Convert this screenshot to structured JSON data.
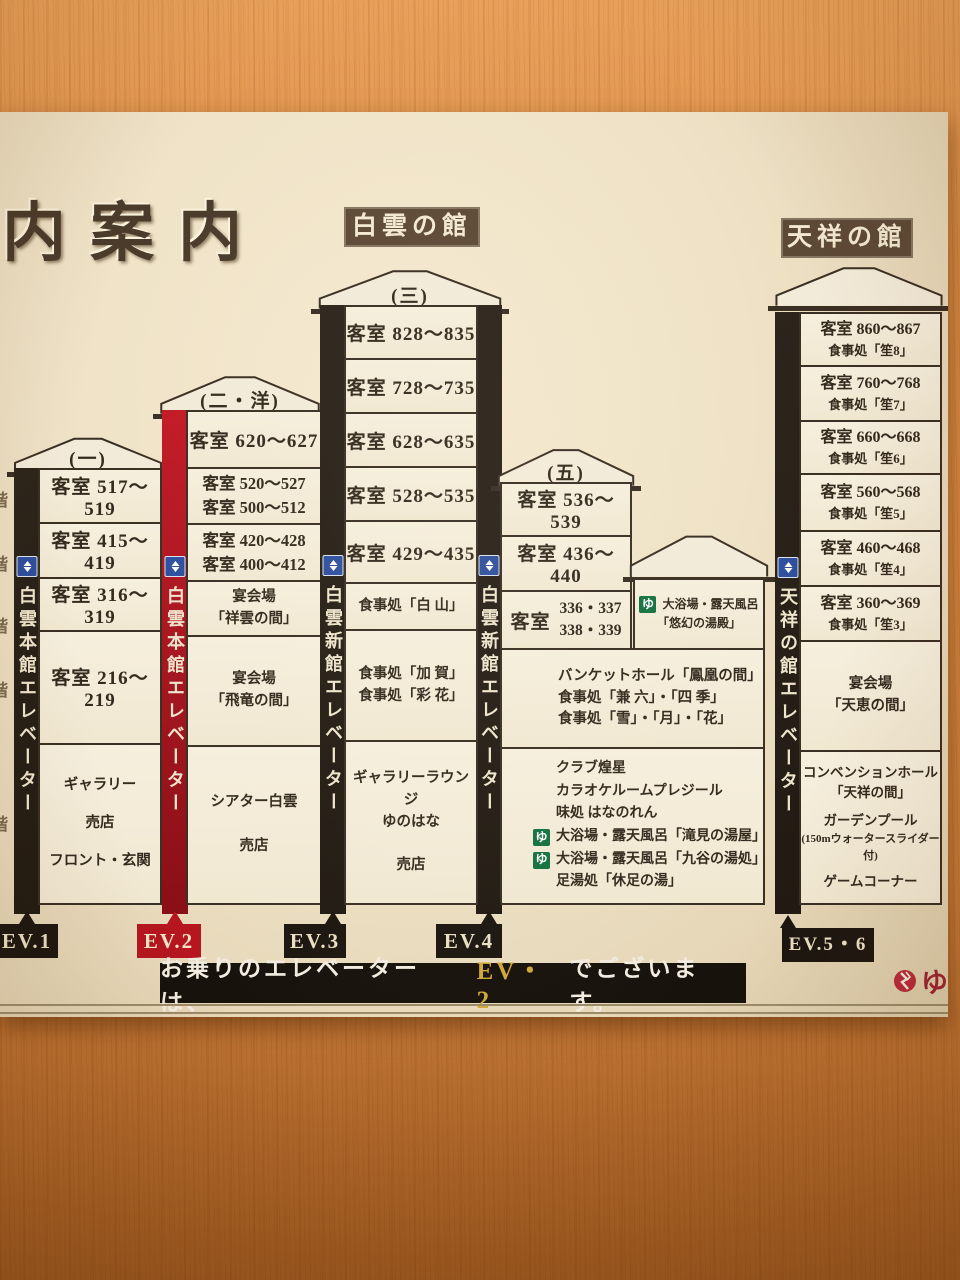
{
  "sign": {
    "title": "内案内",
    "badges": {
      "hakuun": "白雲の館",
      "tensho": "天祥の館"
    },
    "floor_marker": "階",
    "towers": {
      "t1": {
        "roof_label": "(一)",
        "elevator_label": "白雲本館エレベーター",
        "ev_badge": "EV.1",
        "floors": [
          [
            "客室 517〜519"
          ],
          [
            "客室 415〜419"
          ],
          [
            "客室 316〜319"
          ],
          [
            "客室 216〜219"
          ],
          [
            "ギャラリー",
            "売店",
            "フロント・玄関"
          ]
        ]
      },
      "t2": {
        "roof_label": "(二・洋)",
        "elevator_label": "白雲本館エレベーター",
        "ev_badge": "EV.2",
        "floors": [
          [
            "客室 620〜627"
          ],
          [
            "客室 520〜527",
            "客室 500〜512"
          ],
          [
            "客室 420〜428",
            "客室 400〜412"
          ],
          [
            "宴会場",
            "「祥雲の間」"
          ],
          [
            "宴会場",
            "「飛竜の間」"
          ],
          [
            "シアター白雲",
            "売店"
          ]
        ]
      },
      "t3": {
        "roof_label": "(三)",
        "elevator_label_left": "白雲新館エレベーター",
        "elevator_label_right": "白雲新館エレベーター",
        "ev_badge_left": "EV.3",
        "ev_badge_right": "EV.4",
        "floors": [
          [
            "客室 828〜835"
          ],
          [
            "客室 728〜735"
          ],
          [
            "客室 628〜635"
          ],
          [
            "客室 528〜535"
          ],
          [
            "客室 429〜435"
          ],
          [
            "食事処「白 山」"
          ],
          [
            "食事処「加 賀」",
            "食事処「彩 花」"
          ],
          [
            "ギャラリーラウンジ",
            "ゆのはな",
            "売店"
          ]
        ]
      },
      "t4": {
        "roof_label": "(五)",
        "floors": [
          [
            "客室 536〜539"
          ],
          [
            "客室 436〜440"
          ]
        ],
        "f3": {
          "label": "客室",
          "nums": [
            "336・337",
            "338・339"
          ]
        },
        "wide1": [
          "バンケットホール「鳳凰の間」",
          "食事処「兼 六」・「四 季」",
          "食事処「雪」・「月」・「花」"
        ],
        "wide2": [
          "クラブ煌星",
          "カラオケルームプレジール",
          "味処 はなのれん",
          "大浴場・露天風呂「滝見の湯屋」",
          "大浴場・露天風呂「九谷の湯処」",
          "足湯処「休足の湯」"
        ]
      },
      "annex_bath": {
        "lines": [
          "大浴場・露天風呂",
          "「悠幻の湯殿」"
        ]
      },
      "t5": {
        "elevator_label": "天祥の館エレベーター",
        "ev_badge": "EV.5・6",
        "floors": [
          [
            "客室 860〜867",
            "食事処「笙8」"
          ],
          [
            "客室 760〜768",
            "食事処「笙7」"
          ],
          [
            "客室 660〜668",
            "食事処「笙6」"
          ],
          [
            "客室 560〜568",
            "食事処「笙5」"
          ],
          [
            "客室 460〜468",
            "食事処「笙4」"
          ],
          [
            "客室 360〜369",
            "食事処「笙3」"
          ],
          [
            "宴会場",
            "「天恵の間」"
          ],
          [
            "コンベンションホール",
            "「天祥の間」",
            "ガーデンプール",
            "(150mウォータースライダー付)",
            "ゲームコーナー"
          ]
        ]
      }
    },
    "notice": {
      "pre": "お乗りのエレベーターは、",
      "ev": "EV・2",
      "post": "でございます。"
    },
    "icons": {
      "bath": "ゆ",
      "logo": "ゆ"
    },
    "colors": {
      "accent_red": "#b5161f",
      "bar_black": "#262019",
      "gold": "#d0a73c",
      "badge_brown": "#5c4936",
      "bath_green": "#14713f",
      "elevator_blue": "#2e4f9e"
    }
  }
}
